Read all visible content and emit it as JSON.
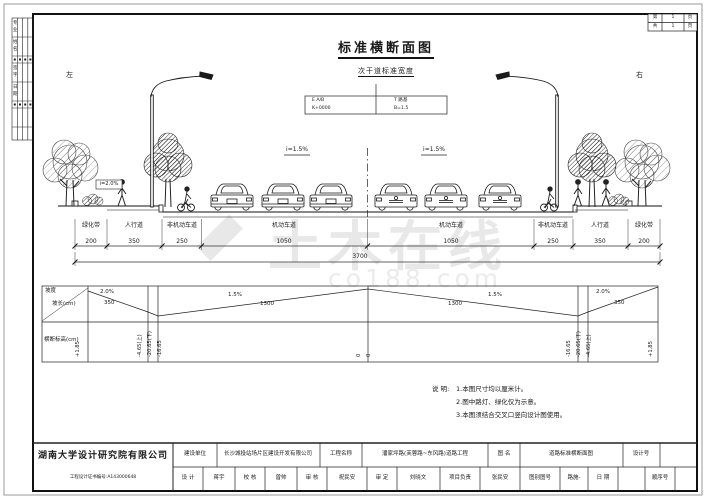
{
  "sheet": {
    "left_label": "左",
    "right_label": "右"
  },
  "title": {
    "main": "标准横断面图",
    "sub": "次干道标准宽度"
  },
  "marker_table": {
    "l1": "E A/B",
    "l2": "K+0000",
    "r1": "T 路基",
    "r2": "B=1.5"
  },
  "slope_labels": {
    "carriage_left": "i=1.5%",
    "carriage_right": "i=1.5%",
    "sidewalk": "i=2.0%"
  },
  "dims": {
    "labels": [
      "绿化带",
      "人行道",
      "非机动车道",
      "机动车道",
      "机动车道",
      "非机动车道",
      "人行道",
      "绿化带"
    ],
    "values": [
      "200",
      "350",
      "250",
      "1050",
      "1050",
      "250",
      "350",
      "200"
    ],
    "total": "3700"
  },
  "slope_table": {
    "header_slope": "坡度",
    "header_length": "坡长(cm)",
    "header_elev": "横断标高(cm)",
    "segments": [
      {
        "slope": "2.0%",
        "length": "350"
      },
      {
        "slope": "1.5%",
        "length": "1300"
      },
      {
        "slope": "1.5%",
        "length": "1300"
      },
      {
        "slope": "2.0%",
        "length": "350"
      }
    ],
    "elevations": [
      "+1.85",
      "-4.65(上)",
      "-20.65(下)",
      "-16.65",
      "0",
      "0",
      "-16.65",
      "-20.65(下)",
      "-4.65(上)",
      "+1.85"
    ]
  },
  "notes": {
    "title": "说 明:",
    "line1": "1.本图尺寸均以厘米计。",
    "line2": "2.图中路灯、绿化仅为示意。",
    "line3": "3.本图须结合交叉口竖向设计图使用。"
  },
  "titleblock": {
    "company": "湖南大学设计研究院有限公司",
    "cert": "工程设计证书编号:A143000648",
    "r1c1": "建设单位",
    "r1v1": "长沙城投站场片区建设开发有限公司",
    "r1c2": "工程名称",
    "r1v2": "潘家坪路(芙蓉路~东风路)道路工程",
    "r1c3": "图 名",
    "r1v3": "道路标准横断面图",
    "r1c4": "设计号",
    "r2c1": "设 计",
    "r2v1": "蒋宇",
    "r2c2": "校 核",
    "r2v2": "曾帅",
    "r2c3": "审 核",
    "r2v3": "祝民安",
    "r2c4": "审 定",
    "r2v4": "刘晓文",
    "r2c5": "项目负责",
    "r2v5": "张民安",
    "r2c6": "图别图号",
    "r2v6": "路施-",
    "r2c7": "日 期",
    "r2c8": "顺序号"
  },
  "page_table": {
    "r1a": "第",
    "r1b": "1",
    "r1c": "页",
    "r2a": "共",
    "r2b": "1",
    "r2c": "页"
  },
  "signoff_strip": {
    "chars": [
      "专",
      "业",
      "姓",
      "名",
      "签",
      "字",
      "日",
      "期"
    ]
  },
  "watermark": {
    "text": "土木在线",
    "sub": "co188.com"
  }
}
